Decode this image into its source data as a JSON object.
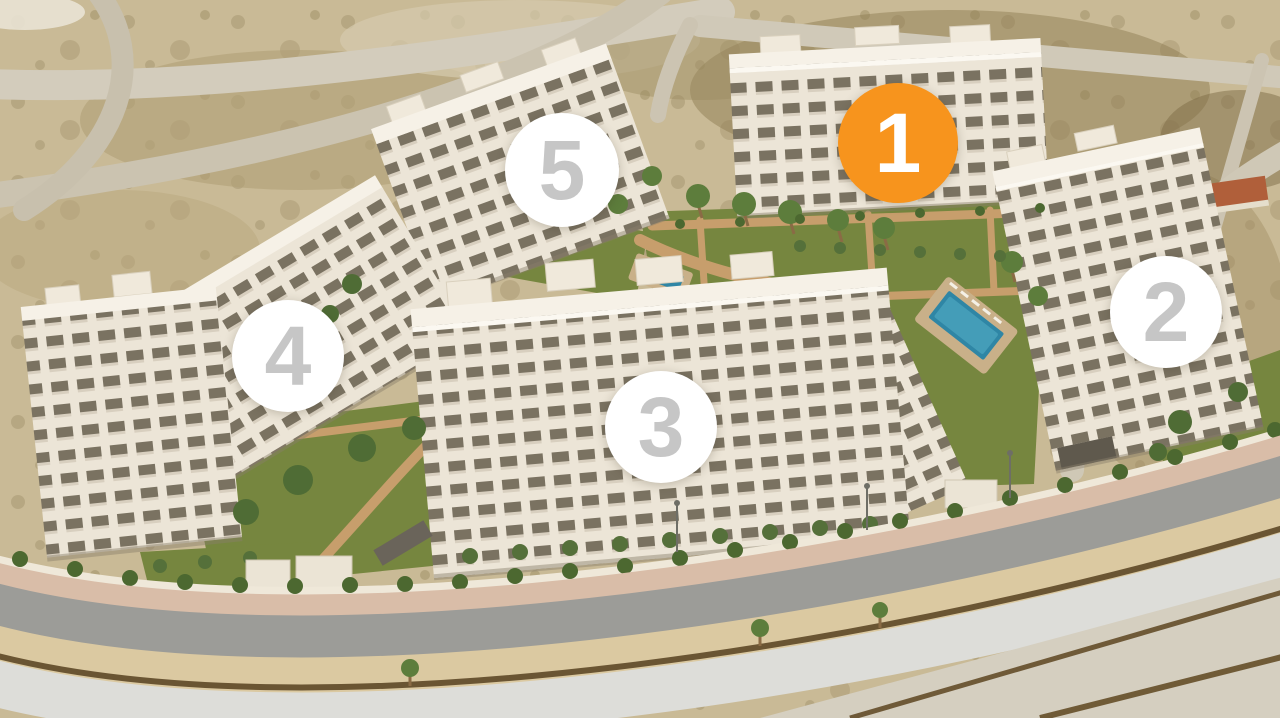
{
  "scene": {
    "description": "Aerial 3D render of a residential apartment development with five numbered phase markers; phase 1 is highlighted in orange"
  },
  "badges": [
    {
      "number": "1",
      "highlighted": true
    },
    {
      "number": "2",
      "highlighted": false
    },
    {
      "number": "3",
      "highlighted": false
    },
    {
      "number": "4",
      "highlighted": false
    },
    {
      "number": "5",
      "highlighted": false
    }
  ],
  "colors": {
    "badge_highlight_bg": "#F7941D",
    "badge_highlight_text": "#FFFFFF",
    "badge_default_bg": "#FFFFFF",
    "badge_default_text": "#C6C6C6",
    "terrain_sand": "#C9BA96",
    "lawn_green": "#76863F",
    "pool_water": "#2F86A5",
    "building_facade": "#ECE5D7",
    "road_asphalt": "#9C9C98",
    "path_terracotta": "#C79E6C"
  }
}
